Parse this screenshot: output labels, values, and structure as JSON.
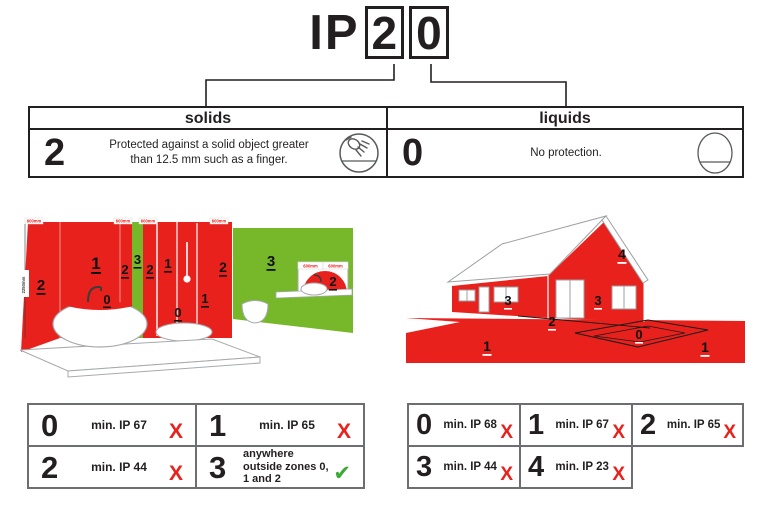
{
  "title": {
    "prefix": "IP",
    "solids_digit": "2",
    "liquids_digit": "0"
  },
  "ip_table": {
    "solids": {
      "header": "solids",
      "rating": "2",
      "description": "Protected against a solid object greater than 12.5 mm such as a finger.",
      "icon": "finger-probe-icon"
    },
    "liquids": {
      "header": "liquids",
      "rating": "0",
      "description": "No protection.",
      "icon": "no-water-protection-icon"
    }
  },
  "bathroom_diagram": {
    "dim_label": "600mm",
    "height_label": "2250mm",
    "labels": {
      "side2": "2",
      "tub1": "1",
      "tub0": "0",
      "strip2a": "2",
      "strip3": "3",
      "strip2b": "2",
      "shower1a": "1",
      "shower0": "0",
      "shower1b": "1",
      "strip2c": "2",
      "wall3": "3",
      "basin2": "2"
    }
  },
  "house_diagram": {
    "labels": {
      "roof4": "4",
      "wall3a": "3",
      "wall3b": "3",
      "terrace2": "2",
      "pool0": "0",
      "ground1a": "1",
      "ground1b": "1"
    }
  },
  "bathroom_requirements": {
    "cells": [
      {
        "zone": "0",
        "requirement": "min. IP 67",
        "mark": "X"
      },
      {
        "zone": "1",
        "requirement": "min. IP 65",
        "mark": "X"
      },
      {
        "zone": "2",
        "requirement": "min. IP 44",
        "mark": "X"
      },
      {
        "zone": "3",
        "requirement": "anywhere outside zones 0, 1 and 2",
        "mark": "✔"
      }
    ]
  },
  "outdoor_requirements": {
    "cells": [
      {
        "zone": "0",
        "requirement": "min. IP 68",
        "mark": "X"
      },
      {
        "zone": "1",
        "requirement": "min. IP 67",
        "mark": "X"
      },
      {
        "zone": "2",
        "requirement": "min. IP 65",
        "mark": "X"
      },
      {
        "zone": "3",
        "requirement": "min. IP 44",
        "mark": "X"
      },
      {
        "zone": "4",
        "requirement": "min. IP 23",
        "mark": "X"
      }
    ]
  },
  "colors": {
    "zone_red": "#e8211c",
    "zone_green": "#76b82a",
    "fail_red": "#e8211c",
    "pass_green": "#3aaa35",
    "line_dark": "#231f20",
    "table_border_gray": "#6d6e71"
  }
}
